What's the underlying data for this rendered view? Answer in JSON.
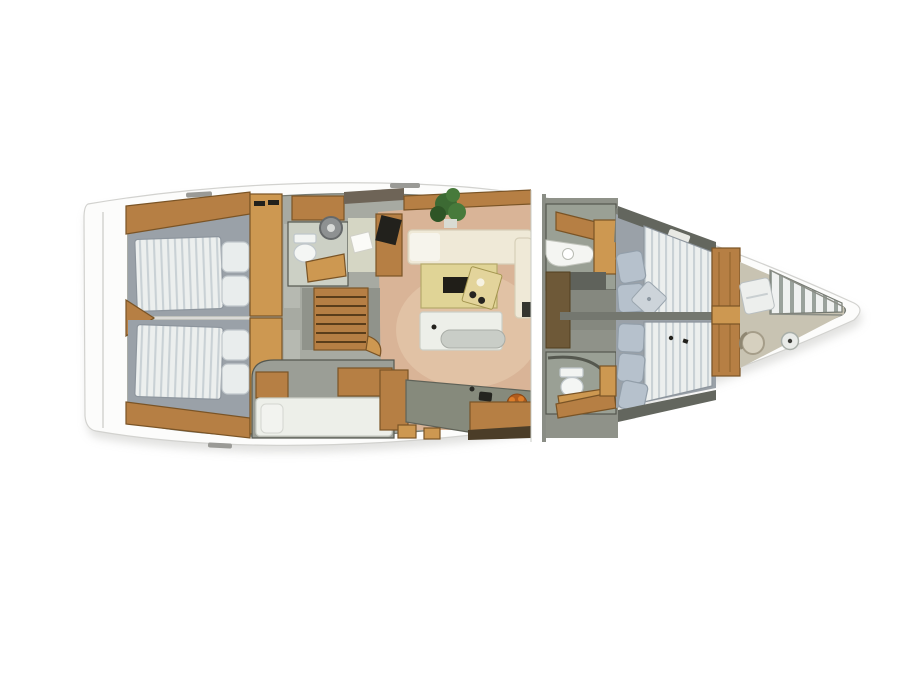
{
  "scene": {
    "description": "Top-down 3D rendered interior layout plan of a sailing yacht, bow pointing right, on a white background",
    "orientation": "bow-right",
    "text_on_image": ""
  },
  "colors": {
    "white": "#ffffff",
    "hull": "#fcfcfb",
    "hull_edge": "#d2d2cf",
    "shadow": "#c9c9c6",
    "interior": "#a7aaa2",
    "interior_edge": "#767a72",
    "wall": "#55584f",
    "wood": "#b67f44",
    "wood_light": "#cd9851",
    "wood_dark": "#7a5426",
    "wood_face": "#6e5938",
    "platform": "#9aa1a8",
    "platform_edge": "#8d959d",
    "mattress": "#ecefee",
    "mattress_stripe": "#c9d1d5",
    "pillow": "#e9eded",
    "pillow_edge": "#c0c7cb",
    "pillow_fwd": "#b6c1cc",
    "pillow_fwd_edge": "#939faa",
    "sofa": "#efe9d7",
    "sofa_edge": "#d6cfb8",
    "sofa_white": "#f6f4ec",
    "table": "#e0d496",
    "table_edge": "#b5a96a",
    "tray": "#e3d49b",
    "dark": "#22211c",
    "floor": "#d9b497",
    "floor_light": "#e9cfb4",
    "counter": "#868a7c",
    "counter_edge": "#5f6258",
    "bench": "#edefe9",
    "bench_edge": "#cccfc7",
    "bolster": "#c9cdc7",
    "door": "#b6b9b1",
    "head_floor": "#ccd0c5",
    "nav_floor": "#d5d6c4",
    "plant": "#3c6a33",
    "plant_light": "#477a3b",
    "plant_dark": "#2e5526",
    "pot": "#d9dbd3",
    "orange": "#dd7d2a",
    "orange_deep": "#b05c1d",
    "bone": "#c8c3b2",
    "slat": "#eff1f0",
    "slat_gap": "#9aa29c",
    "paper": "#fbfbf8",
    "dkband": "#63665e",
    "corridor": "#85887f",
    "fwd_base": "#8f9289",
    "head_box": "#9aa095",
    "dark_floor": "#5f625b",
    "seam_wall": "#8a8d85",
    "steel": "#8e9192",
    "hatch": "#9a9a96"
  },
  "areas": {
    "hull": "Yacht hull, top view with bow to the right",
    "aft_cabin_top": "Aft double cabin (upper) with striped mattress and two pillows",
    "aft_cabin_bottom": "Aft double cabin (lower) with striped mattress and two pillows",
    "aft_divider": "Wedge divider between aft cabins",
    "aft_head": "Aft head with toilet and round washer unit",
    "nav_station": "Navigation desk with laptop and papers",
    "companionway": "Companionway stairs",
    "utility_berth": "Single berth utility cabin",
    "saloon": "Saloon with L-shaped sofa, wooden table, tray and chaise bench",
    "galley": "Galley with sink, fruit bowl and cabinets",
    "bulkhead_seam": "Main bulkhead seam at mast position",
    "fwd_head_top": "Forward head (upper) with curved vanity and sink",
    "fwd_head_bottom": "Forward head (lower) with toilet",
    "fwd_cabin_top": "Forward cabin berth (upper) with pillows and folded blanket",
    "fwd_cabin_bottom": "Forward cabin berth (lower) with three pillows",
    "fwd_bulkhead": "Forward wooden bulkhead",
    "forepeak": "Forepeak crew area with cushion, stool, sink and slatted floor",
    "bow": "Bow tip"
  }
}
